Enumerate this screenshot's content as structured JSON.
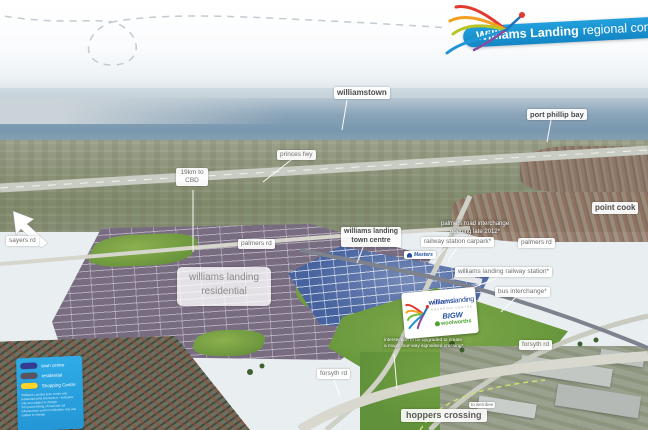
{
  "banner": {
    "brand": "Williams Landing",
    "suffix": "regional context"
  },
  "map_labels": {
    "williamstown": "williamstown",
    "port_phillip_bay": "port phillip bay",
    "princes_fwy": "princes fwy",
    "cbd_distance": "19km to\nCBD",
    "point_cook": "point cook",
    "palmers_interchange_note": "palmers road interchange\nopening late 2012*",
    "railway_station_carpark": "railway station carpark*",
    "palmers_rd_west": "palmers rd",
    "palmers_rd_east": "palmers rd",
    "town_centre": "williams landing\ntown centre",
    "residential": "williams landing\nresidential",
    "railway_station": "williams landing railway station*",
    "bus_interchange": "bus interchange*",
    "forsyth_rd_east": "forsyth rd",
    "forsyth_rd_south": "forsyth rd",
    "sayers_rd": "sayers rd",
    "intersection_note": "intersection to be upgraded to create\na major four-way signalised crossing*",
    "hoppers_crossing": "hoppers crossing",
    "to_werribee": "to werribee"
  },
  "shopping_centre_card": {
    "brand_bold": "williams",
    "brand_light": "landing",
    "subtitle": "SHOPPING CENTRE",
    "tenant_bigw": "BIGW",
    "tenant_woolworths": "woolworths"
  },
  "masters_label": "Masters",
  "legend": {
    "items": [
      {
        "label": "town centre",
        "color": "#343b91"
      },
      {
        "label": "residential",
        "color": "#5d5360"
      },
      {
        "label": "Shopping Centre",
        "color": "#ffd42a"
      }
    ],
    "fineprint": "*Williams Landing town centre and residential artist impression – indicative only and subject to change.\n*Proposed timing of road and rail infrastructure works is indicative only and subject to change."
  },
  "icons": {
    "logo": "dragonfly-logo",
    "direction_arrow": "nw-direction-arrow",
    "apple": "woolworths-apple"
  },
  "brand_colors": {
    "banner_blue": "#1b93d1",
    "legend_blue": "#2aa5e1",
    "red": "#e23a2e",
    "orange": "#f49f1f",
    "olive": "#b9c425",
    "green": "#6cbf3e",
    "blue": "#2196d6",
    "purple": "#8a4a9e",
    "woolworths_green": "#4aa32f",
    "bigw_blue": "#1f4fa0"
  }
}
